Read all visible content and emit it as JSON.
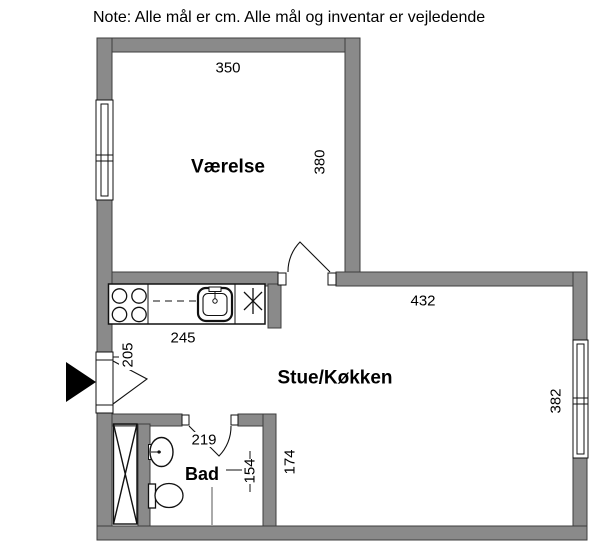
{
  "note": "Note: Alle mål er cm. Alle mål og inventar er vejledende",
  "rooms": {
    "vaerelse": {
      "name": "Værelse",
      "width_cm": "350",
      "height_cm": "380"
    },
    "stue": {
      "name": "Stue/Køkken",
      "width_cm": "432",
      "height_cm": "382"
    },
    "bad": {
      "name": "Bad",
      "width_cm": "154",
      "height_cm": "174"
    },
    "entry": {
      "opening_cm": "205",
      "hall_cm": "219"
    },
    "kitchen": {
      "counter_cm": "245"
    }
  },
  "symbols": {
    "entrance_arrow": "right-filled-triangle",
    "stove": "four-burner-cooktop",
    "kitchen_sink": "sink-with-faucet",
    "appliance_asterisk": "six-ray-asterisk",
    "wardrobe": "crossed-box",
    "washbasin": "oval-basin-with-tap",
    "toilet": "toilet-side-symbol",
    "windows": "double-frame-window",
    "doors": "arc-door-swing"
  },
  "colors": {
    "wall": "#8a8a8a",
    "wall_outline": "#3d3d3d",
    "line": "#111111",
    "background": "#ffffff"
  }
}
